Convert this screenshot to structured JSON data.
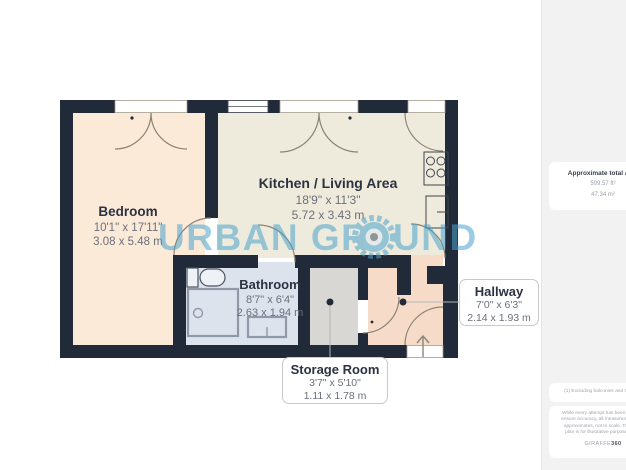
{
  "plan": {
    "bedroom": {
      "name": "Bedroom",
      "imperial": "10'1\" x 17'11\"",
      "metric": "3.08 x 5.48 m"
    },
    "kitchen": {
      "name": "Kitchen / Living Area",
      "imperial": "18'9\" x 11'3\"",
      "metric": "5.72 x 3.43 m"
    },
    "bathroom": {
      "name": "Bathroom",
      "imperial": "8'7\" x 6'4\"",
      "metric": "2.63 x 1.94 m"
    },
    "storage": {
      "name": "Storage Room",
      "imperial": "3'7\" x 5'10\"",
      "metric": "1.11 x 1.78 m"
    },
    "hallway": {
      "name": "Hallway",
      "imperial": "7'0\" x 6'3\"",
      "metric": "2.14 x 1.93 m"
    }
  },
  "watermark": {
    "text_left": "URBAN GR",
    "text_right": "UND"
  },
  "sidebar": {
    "area_title": "Approximate total area",
    "area_ft": "509.57 ft²",
    "area_m": "47.34 m²",
    "footnote": "(1) Excluding balconies and terraces",
    "disclaimer_lines": [
      "While every attempt has been made to",
      "ensure accuracy, all measurements are",
      "approximates, not to scale. This floor",
      "plan is for illustrative purposes only."
    ],
    "logo_giraffe": "GIRAFFE",
    "logo_360": "360"
  },
  "colors": {
    "wall": "#212a38",
    "bedroom_fill": "#fcead9",
    "kitchen_fill": "#efebdc",
    "bathroom_fill": "#dde3ed",
    "storage_fill": "#d8d7d3",
    "hallway_fill": "#f5dbc8",
    "watermark_blue": "#4aa3cf",
    "room_name_text": "#2b3240",
    "dim_text": "#6b707b"
  }
}
